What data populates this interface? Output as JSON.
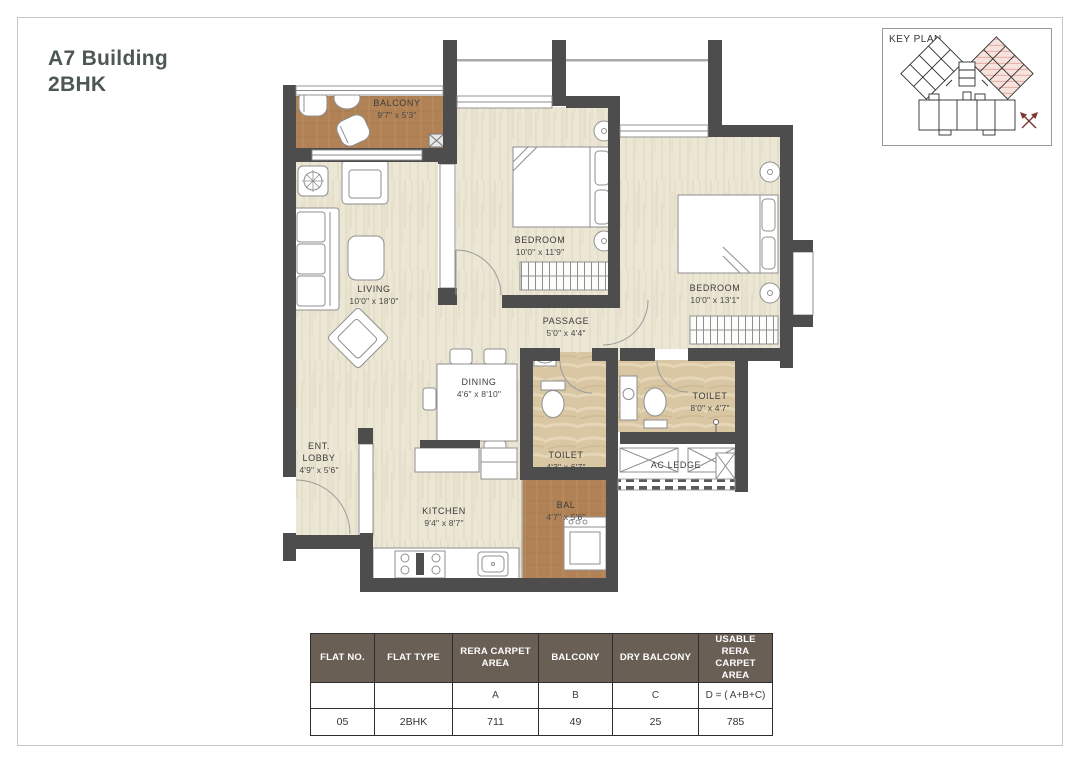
{
  "title": {
    "line1": "A7 Building",
    "line2": "2BHK"
  },
  "key_plan": {
    "label": "KEY PLAN"
  },
  "rooms": {
    "balcony": {
      "name": "BALCONY",
      "dims": "9'7\" x 5'3\""
    },
    "living": {
      "name": "LIVING",
      "dims": "10'0\" x 18'0\""
    },
    "bedroom1": {
      "name": "BEDROOM",
      "dims": "10'0\" x 11'9\""
    },
    "bedroom2": {
      "name": "BEDROOM",
      "dims": "10'0\" x 13'1\""
    },
    "passage": {
      "name": "PASSAGE",
      "dims": "5'0\" x 4'4\""
    },
    "dining": {
      "name": "DINING",
      "dims": "4'6\" x 8'10\""
    },
    "ent_lobby": {
      "name1": "ENT.",
      "name2": "LOBBY",
      "dims": "4'9\" x 5'6\""
    },
    "kitchen": {
      "name": "KITCHEN",
      "dims": "9'4\" x 8'7\""
    },
    "toilet1": {
      "name": "TOILET",
      "dims": "4'3\" x 6'7\""
    },
    "toilet2": {
      "name": "TOILET",
      "dims": "8'0\" x 4'7\""
    },
    "ac_ledge": {
      "name": "AC LEDGE"
    },
    "bal": {
      "name": "BAL",
      "dims": "4'7\" x 5'6\""
    }
  },
  "table": {
    "headers": [
      "FLAT NO.",
      "FLAT TYPE",
      "RERA CARPET AREA",
      "BALCONY",
      "DRY BALCONY",
      "USABLE RERA CARPET AREA"
    ],
    "sub_headers": [
      "",
      "",
      "A",
      "B",
      "C",
      "D = ( A+B+C)"
    ],
    "values": [
      "05",
      "2BHK",
      "711",
      "49",
      "25",
      "785"
    ]
  },
  "colors": {
    "wall": "#4d4d4d",
    "wood_floor": "#ece7d5",
    "balcony_floor": "#b08256",
    "marble_floor": "#d9c6a2",
    "table_header_bg": "#6a5f55",
    "title_text": "#4d5853",
    "keyplan_highlight": "#f7e3de"
  }
}
